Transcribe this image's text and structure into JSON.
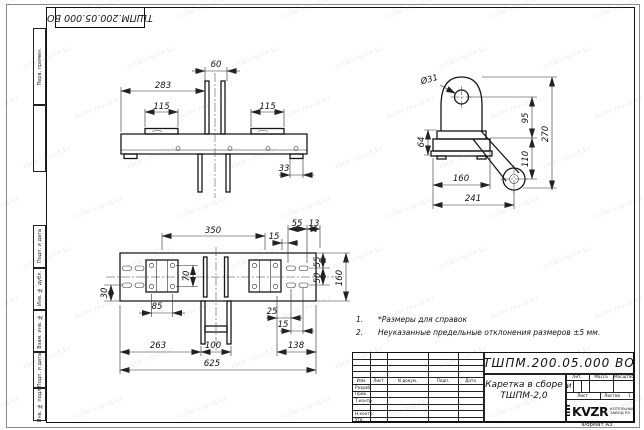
{
  "sheet": {
    "format_label": "Формат А3",
    "watermark_text": "kotel-zavod.kz",
    "paper_color": "#ffffff",
    "line_color": "#1a1a1a"
  },
  "top_stamp": {
    "doc_number_inverted": "ТШПМ.200.05.000  ВО"
  },
  "margin_stamps": [
    "Перв. примен.",
    "Подп. и дата",
    "Инв. № дубл.",
    "Взам. инв. №",
    "Подп. и дата",
    "Инв. № подл."
  ],
  "notes": {
    "items": [
      {
        "num": "1.",
        "text": "*Размеры для справок"
      },
      {
        "num": "2.",
        "text": "Неуказанные предельные отклонения размеров  ±5 мм."
      }
    ]
  },
  "views": {
    "front": {
      "dims": {
        "width_60": "60",
        "width_283": "283",
        "pad_left_115": "115",
        "pad_right_115": "115",
        "foot_33": "33"
      }
    },
    "side": {
      "dims": {
        "hole_dia": "Ø31",
        "height_64": "64",
        "base_160": "160",
        "overall_241": "241",
        "height_95": "95",
        "height_110": "110",
        "overall_270": "270"
      }
    },
    "plan": {
      "dims": {
        "span_350": "350",
        "offset_15_top": "15",
        "slot_55": "55",
        "edge_13": "13",
        "holes_70": "70",
        "holes_85": "85",
        "edge_30": "30",
        "offset_25": "25",
        "offset_15_bot": "15",
        "span_138": "138",
        "span_263": "263",
        "legs_100": "100",
        "overall_625": "625",
        "edge_55": "55",
        "slot_50": "50",
        "width_160": "160"
      }
    }
  },
  "title_block": {
    "doc_number": "ТШПМ.200.05.000  ВО",
    "product_name": "Каретка в сборе",
    "product_code": "ТШПМ-2,0",
    "columns": {
      "izm": "Изм.",
      "list": "Лист",
      "n_dokum": "N докум.",
      "podp": "Подп.",
      "data": "Дата"
    },
    "signature_rows": {
      "razrab": "Разраб.",
      "prov": "Пров.",
      "t_kontr": "Т.контр.",
      "n_kontr": "Н.контр.",
      "utv": "Утв."
    },
    "lit_section": {
      "lit": "Лит.",
      "massa": "Масса",
      "masshtab": "Масштаб",
      "litera_value": "И"
    },
    "sheets": {
      "list_label": "Лист",
      "listov_label": "Листов",
      "listov_value": "1"
    },
    "company": {
      "logo_text": "KVZR",
      "name_line1": "КОТЕЛЬНЫЙ",
      "name_line2": "ЗАВОД РЭ"
    }
  }
}
